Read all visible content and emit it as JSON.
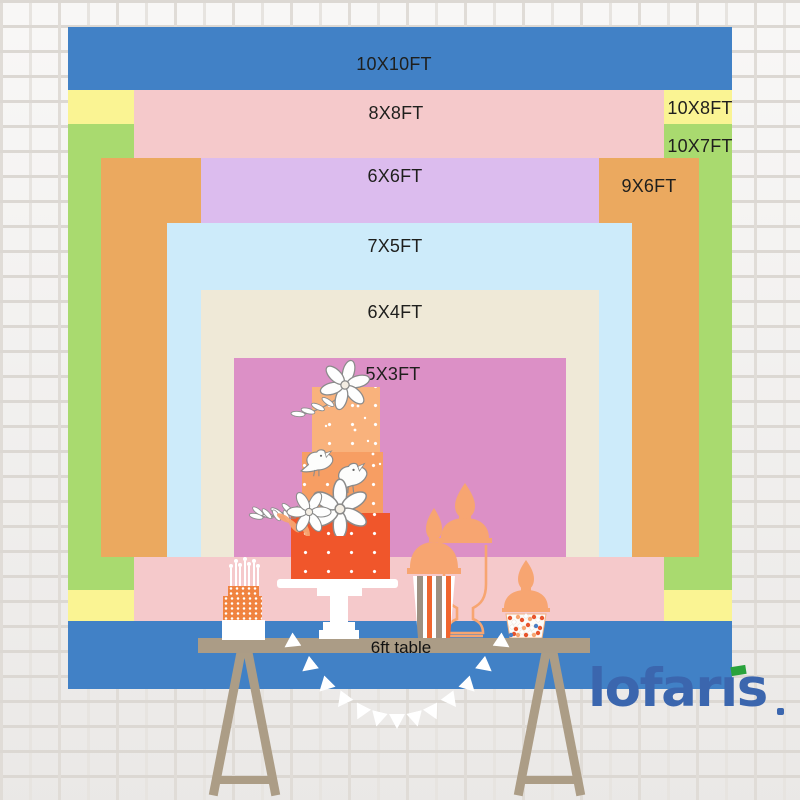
{
  "chart": {
    "title": "backdrop size comparison",
    "sizes": [
      {
        "size": "10X10FT",
        "color": "#4181c6"
      },
      {
        "size": "10X8FT",
        "color": "#faf493"
      },
      {
        "size": "10X7FT",
        "color": "#a9da6f"
      },
      {
        "size": "8X8FT",
        "color": "#f5c9cb"
      },
      {
        "size": "9X6FT",
        "color": "#eba95f"
      },
      {
        "size": "6X6FT",
        "color": "#dcbcee"
      },
      {
        "size": "7X5FT",
        "color": "#cdebfa"
      },
      {
        "size": "6X4FT",
        "color": "#efe9d7"
      },
      {
        "size": "5X3FT",
        "color": "#dc90c6"
      }
    ]
  },
  "table": {
    "label": "6ft table"
  },
  "brand": {
    "name": "lofaris",
    "text_color": "#3b66ae",
    "dot_color": "#2aa33c"
  }
}
